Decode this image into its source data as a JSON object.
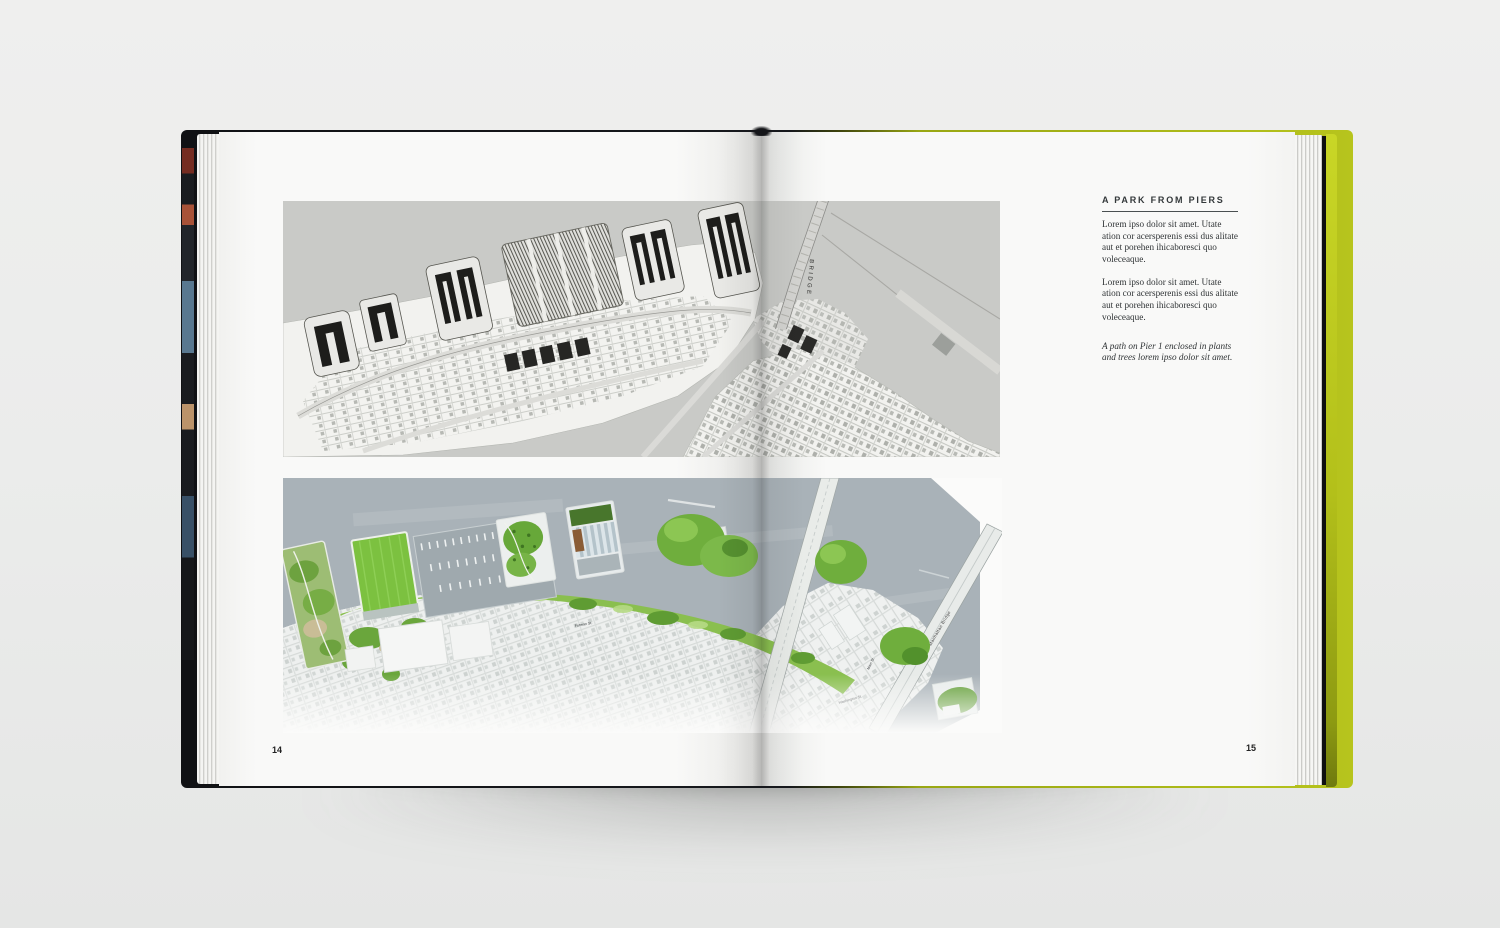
{
  "book": {
    "left_page": {
      "page_number": "14"
    },
    "right_page": {
      "page_number": "15",
      "article": {
        "heading": "A PARK FROM PIERS",
        "para1": "Lorem ipso dolor sit amet. Utate ation cor acersperenis essi dus alitate aut et porehen ihicaboresci quo voleceaque.",
        "para2": "Lorem ipso dolor sit amet. Utate ation cor acersperenis essi dus alitate aut et porehen ihicaboresci quo voleceaque.",
        "caption": "A path on Pier 1 enclosed in plants and trees lorem ipso dolor sit amet."
      }
    },
    "maps": {
      "top": {
        "labels": {
          "bridge": "BRIDGE"
        }
      },
      "bottom": {
        "labels": {
          "manhattan_bridge": "Manhattan Bridge",
          "main_st": "Main St.",
          "washington_st": "Washington St.",
          "furman_st": "Furman St."
        }
      }
    },
    "colors": {
      "background": "#ecedec",
      "page": "#f8f8f7",
      "cover_front_edge": "#16181c",
      "cover_back_edge": "#b5c31b",
      "top_map_water": "#c9cac7",
      "top_map_ink": "#1f1f1d",
      "bottom_map_water": "#a9b2b8",
      "lawn_green": "#7cc140",
      "park_green_dark": "#5f9c33"
    }
  }
}
